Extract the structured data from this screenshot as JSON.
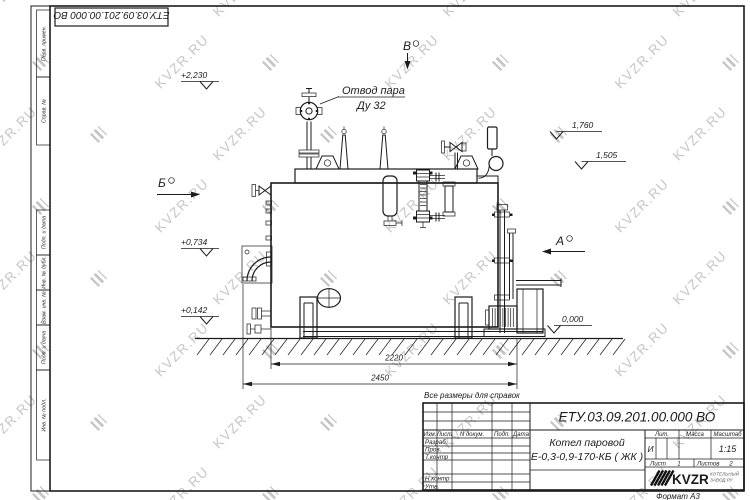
{
  "sheet": {
    "doc_number_top": "ЕТУ.03.09.201.00.000 ВО",
    "format_label": "Формат А3",
    "stamp_fields": [
      "Перв. примен.",
      "Справ. №",
      "Подп. и дата",
      "Инв. № дубл.",
      "Взам. инв. №",
      "Подп. и дата",
      "Инв. № подл."
    ]
  },
  "watermark": {
    "text": "KVZR.RU",
    "color": "#c6c6c6"
  },
  "drawing": {
    "note": "Все размеры для справок",
    "callout": {
      "line1": "Отвод пара",
      "line2": "Ду 32"
    },
    "views": {
      "b": "Б",
      "v": "В",
      "a": "А"
    },
    "elevations": {
      "e2230": "+2,230",
      "e1760": "1,760",
      "e1505": "1,505",
      "e0734": "+0,734",
      "e0142": "+0,142",
      "e0000": "0,000"
    },
    "dims": {
      "d2220": "2220",
      "d2450": "2450"
    }
  },
  "title_block": {
    "doc_number": "ЕТУ.03.09.201.00.000  ВО",
    "name_line1": "Котел паровой",
    "name_line2": "Е-0,3-0,9-170-КБ ( ЖК )",
    "cols": {
      "izm": "Изм.",
      "list": "Лист",
      "doc": "N докум.",
      "podp": "Подп.",
      "data": "Дата"
    },
    "rows": {
      "razrab": "Разраб.",
      "prov": "Пров.",
      "tkontr": "Т.контр",
      "nkontr": "Н.контр",
      "utv": "Утв."
    },
    "lit_label": "Лит.",
    "massa_label": "Масса",
    "scale_label": "Масштаб",
    "lit_value": "И",
    "scale_value": "1:15",
    "sheet_label": "Лист",
    "sheet_value": "1",
    "sheets_label": "Листов",
    "sheets_value": "2",
    "logo_text": "KVZR",
    "logo_sub1": "КОТЕЛЬНЫЙ",
    "logo_sub2": "ЗАВОД.РУ"
  }
}
